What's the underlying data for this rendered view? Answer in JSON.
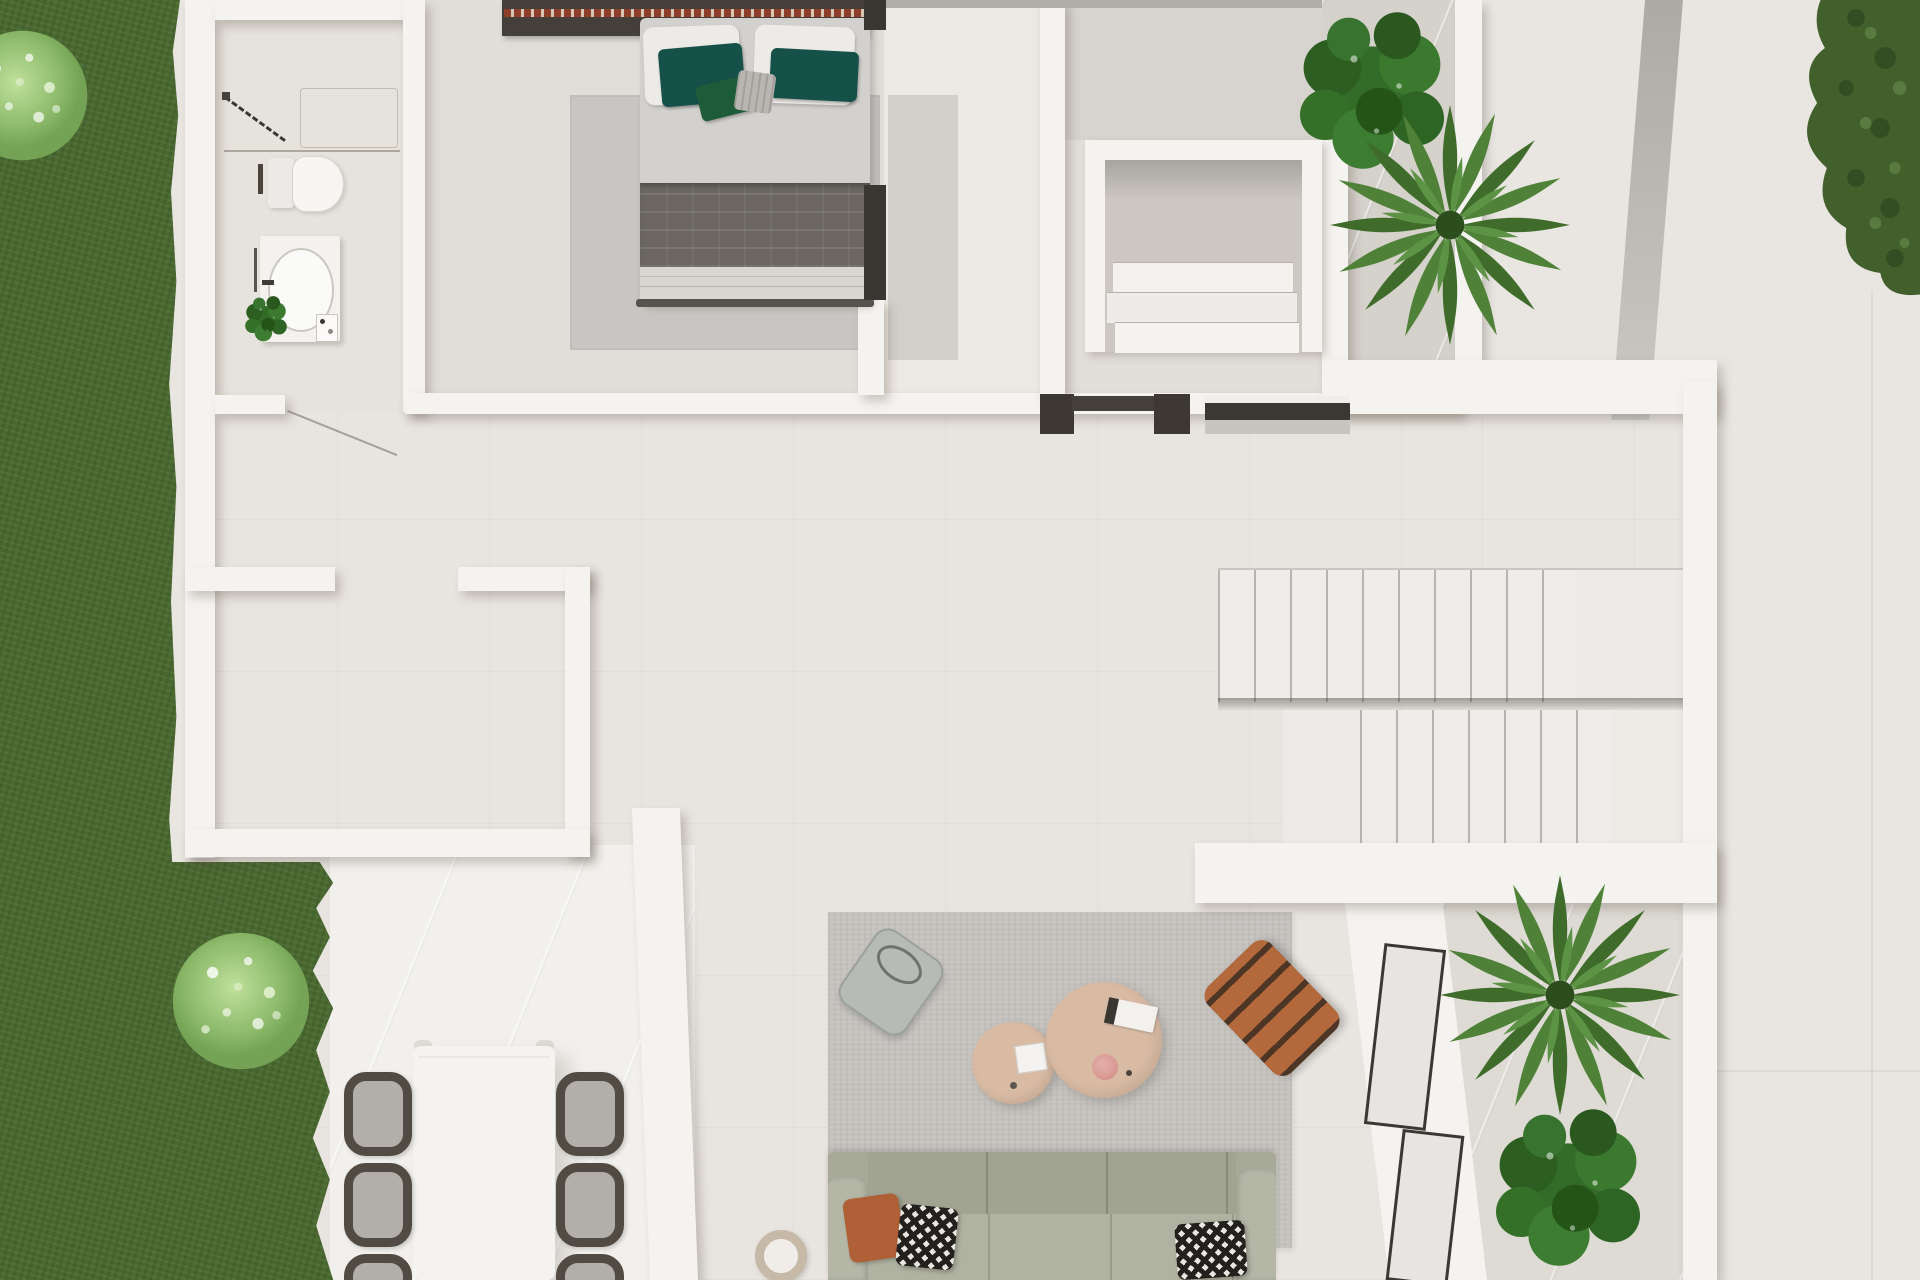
{
  "scene": {
    "type": "3d-floorplan-render",
    "view": "top-down",
    "style": "modern-minimal-villa"
  },
  "colors": {
    "grass": "#4a6930",
    "bush_light": "#9cc87d",
    "hedge": "#41602c",
    "wall": "#f5f3f0",
    "interior": "#e8e4df",
    "terrace": "#e9e6e1",
    "dining_floor": "#f2f0ec",
    "bath_floor": "#e6e2dc",
    "bedroom_floor": "#e1ddd7",
    "corridor_floor": "#ece8e2",
    "laundry_floor": "#e2ded8",
    "stone": "#d5d1cb",
    "planter_stone": "#dedad4",
    "rug_bed": "#c8c5c2",
    "rug_living": "#c5c2be",
    "runner": "#d2cfcb",
    "headboard": "#453f3a",
    "trim_red": "#8f3e2c",
    "duvet": "#d3d1ce",
    "band": "#6b6660",
    "foot": "#d9d6d2",
    "pillow": "#edebe7",
    "teal": "#155049",
    "green": "#1e5c39",
    "knit": "#b9b6b1",
    "sofa": "#a7aa98",
    "sofa_seat": "#b0b3a1",
    "sofa_arm": "#b4b7a6",
    "terracotta": "#b06036",
    "tan": "#d9bba4",
    "lounge": "#b4693d",
    "lounge_dark": "#4e3626",
    "chair_frame": "#514b44",
    "chair_seat": "#b2afaa",
    "white_furn": "#f4f3f0",
    "door_dark": "#3e3833",
    "glaze_dark": "#3b3733"
  },
  "counts": {
    "dining_chairs_visible": 6,
    "upper_stair_treads": 10,
    "lower_stair_treads": 7,
    "coffee_tables": 2,
    "sofa_throw_pillows": 3,
    "bed_cushions": 4,
    "indoor_planters": 2,
    "garden_bushes": 2
  },
  "rooms": [
    "garden",
    "bathroom",
    "bedroom",
    "walk-in-closet",
    "laundry-nook",
    "courtyard-planter",
    "hallway",
    "storage-room",
    "staircase",
    "dining-terrace",
    "living-room",
    "window-planter",
    "terrace"
  ]
}
